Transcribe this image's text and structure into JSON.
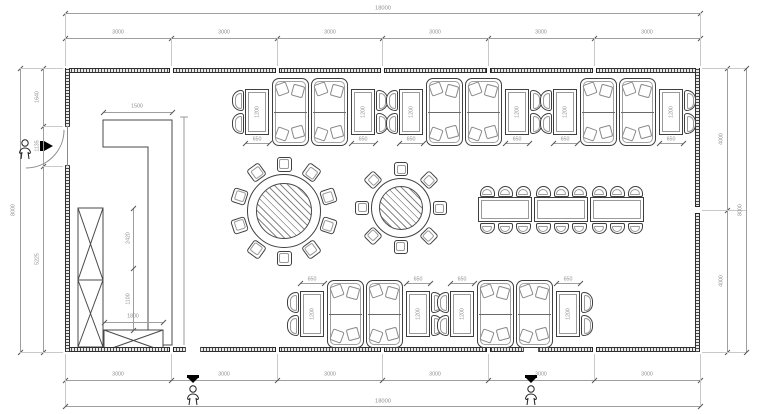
{
  "colors": {
    "line": "#3f3f3f",
    "dim_line": "#9f9f9f",
    "dim_text": "#8f8f8f",
    "wall": "#4a4a4a",
    "marker": "#000000"
  },
  "dimensions": {
    "top_total": "18000",
    "top_segments": [
      "3000",
      "3000",
      "3000",
      "3000",
      "3000",
      "3000"
    ],
    "bottom_total": "18000",
    "bottom_segments": [
      "3000",
      "3000",
      "3000",
      "3000",
      "3000",
      "3000"
    ],
    "left_total": "8000",
    "left_segments": [
      "1640",
      "1135",
      "5225"
    ],
    "right_total": "8000",
    "right_segments": [
      "4000",
      "4000"
    ]
  },
  "labels": {
    "counter_width": "1500",
    "cabinet_upper": "2420",
    "cabinet_lower": "1100",
    "cabinet_bottom_width": "1800",
    "booth_table_width": "650",
    "booth_table_depth": "1200"
  },
  "furniture": {
    "top_booth_groups": 3,
    "bottom_booth_groups": 2,
    "round_table_large_chairs": 10,
    "round_table_small_chairs": 8,
    "banquet_tables": 3,
    "banquet_chairs_per_side": 3
  },
  "icons": {
    "entry_person": "person-icon",
    "entrance_arrow": "entrance-arrow-icon",
    "exit_marker": "exit-marker-icon"
  }
}
